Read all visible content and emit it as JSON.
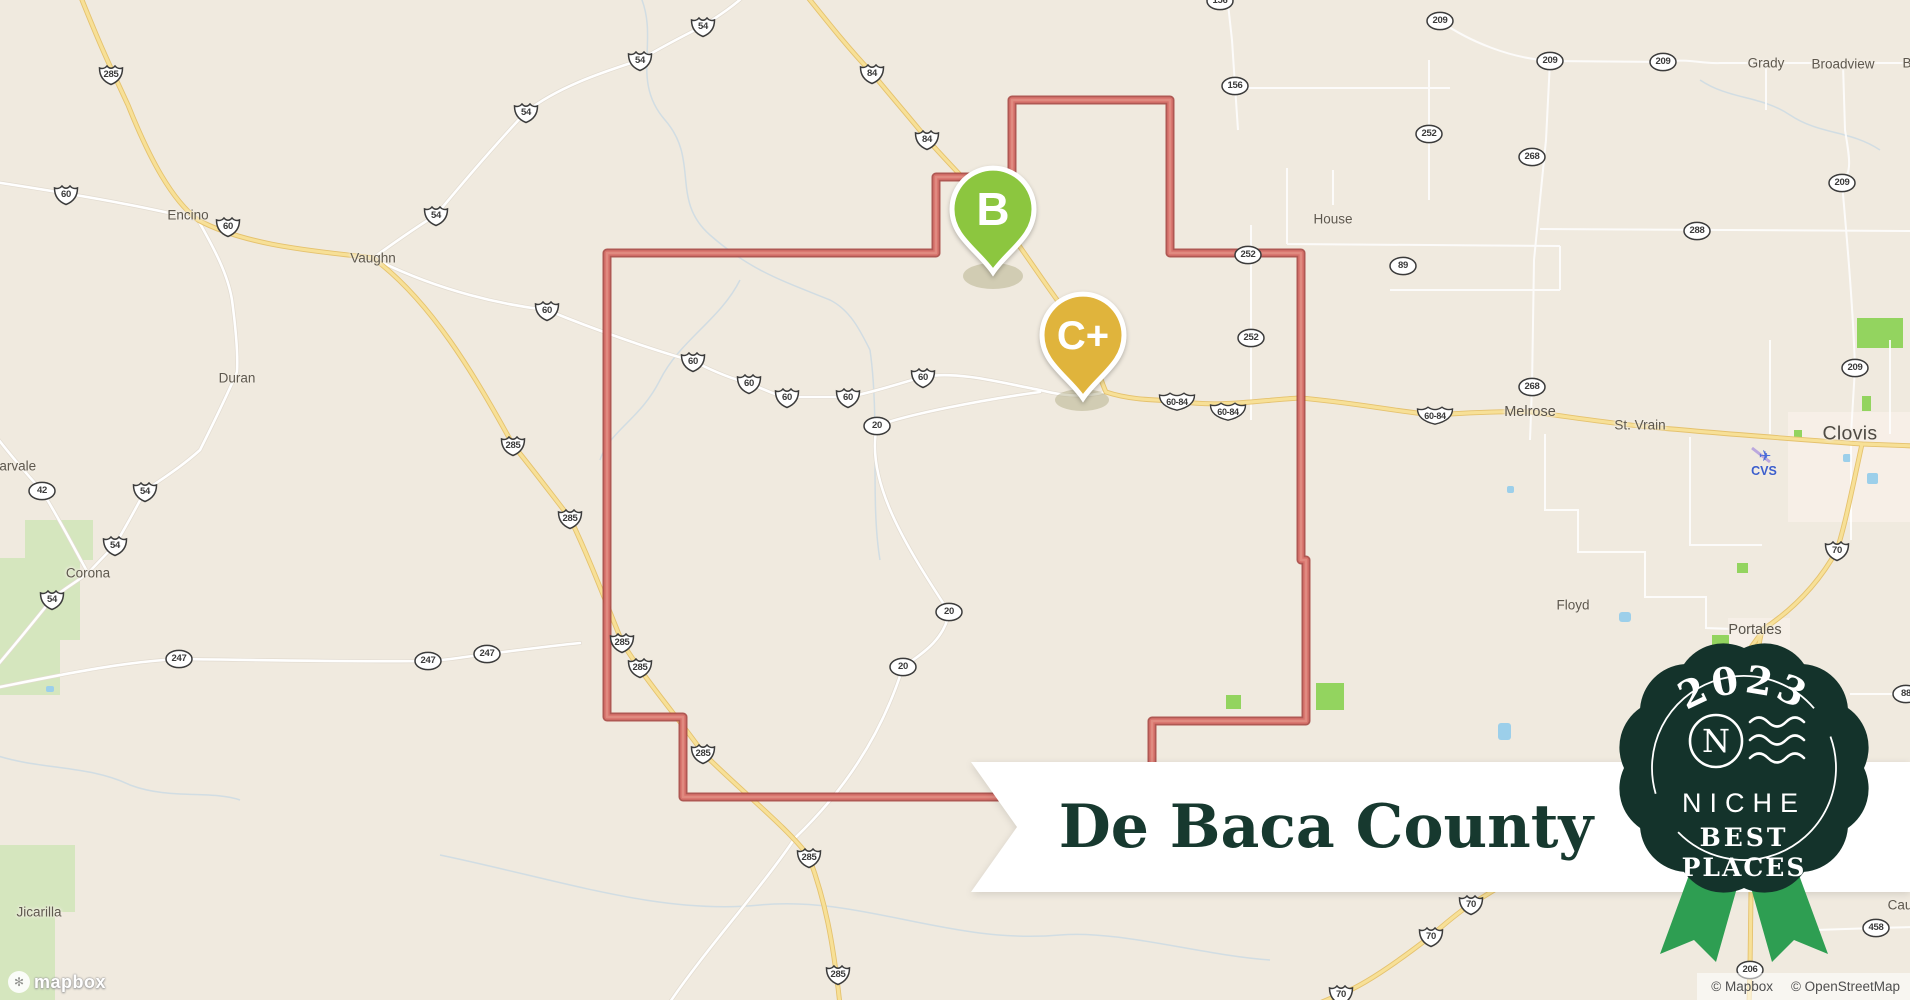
{
  "map": {
    "banner": {
      "title": "De Baca County"
    },
    "badge": {
      "year": "2023",
      "brand": "NICHE",
      "line1": "BEST",
      "line2": "PLACES"
    },
    "markers": [
      {
        "grade": "B",
        "color": "#8CC63F",
        "x": 993,
        "y": 210
      },
      {
        "grade": "C+",
        "color": "#E0B43C",
        "x": 1083,
        "y": 336
      }
    ],
    "towns": [
      {
        "name": "Encino",
        "x": 188,
        "y": 215,
        "cls": "sm"
      },
      {
        "name": "Vaughn",
        "x": 373,
        "y": 258,
        "cls": "sm"
      },
      {
        "name": "Duran",
        "x": 237,
        "y": 378,
        "cls": "sm"
      },
      {
        "name": "Corona",
        "x": 88,
        "y": 573,
        "cls": "sm"
      },
      {
        "name": "darvale",
        "x": 14,
        "y": 466,
        "cls": "sm"
      },
      {
        "name": "Jicarilla",
        "x": 39,
        "y": 912,
        "cls": "sm"
      },
      {
        "name": "House",
        "x": 1333,
        "y": 219,
        "cls": "sm"
      },
      {
        "name": "Melrose",
        "x": 1530,
        "y": 412,
        "cls": "md"
      },
      {
        "name": "St. Vrain",
        "x": 1640,
        "y": 425,
        "cls": "sm"
      },
      {
        "name": "Clovis",
        "x": 1850,
        "y": 434,
        "cls": "lg"
      },
      {
        "name": "Floyd",
        "x": 1573,
        "y": 605,
        "cls": "sm"
      },
      {
        "name": "Portales",
        "x": 1755,
        "y": 630,
        "cls": "md"
      },
      {
        "name": "Grady",
        "x": 1766,
        "y": 63,
        "cls": "sm"
      },
      {
        "name": "Broadview",
        "x": 1843,
        "y": 64,
        "cls": "sm"
      },
      {
        "name": "B",
        "x": 1907,
        "y": 63,
        "cls": "sm"
      },
      {
        "name": "Cau",
        "x": 1900,
        "y": 905,
        "cls": "sm"
      },
      {
        "name": "CVS",
        "x": 1764,
        "y": 471,
        "cls": "cvs"
      }
    ],
    "shields": [
      {
        "type": "us",
        "label": "54",
        "x": 703,
        "y": 26
      },
      {
        "type": "us",
        "label": "54",
        "x": 640,
        "y": 60
      },
      {
        "type": "us",
        "label": "54",
        "x": 526,
        "y": 112
      },
      {
        "type": "us",
        "label": "54",
        "x": 436,
        "y": 215
      },
      {
        "type": "us",
        "label": "54",
        "x": 145,
        "y": 491
      },
      {
        "type": "us",
        "label": "54",
        "x": 115,
        "y": 545
      },
      {
        "type": "us",
        "label": "54",
        "x": 52,
        "y": 599
      },
      {
        "type": "us",
        "label": "84",
        "x": 872,
        "y": 73
      },
      {
        "type": "us",
        "label": "84",
        "x": 927,
        "y": 139
      },
      {
        "type": "us",
        "label": "60",
        "x": 66,
        "y": 194
      },
      {
        "type": "us",
        "label": "60",
        "x": 228,
        "y": 226
      },
      {
        "type": "us",
        "label": "60",
        "x": 547,
        "y": 310
      },
      {
        "type": "us",
        "label": "60",
        "x": 693,
        "y": 361
      },
      {
        "type": "us",
        "label": "60",
        "x": 749,
        "y": 383
      },
      {
        "type": "us",
        "label": "60",
        "x": 787,
        "y": 397
      },
      {
        "type": "us",
        "label": "60",
        "x": 848,
        "y": 397
      },
      {
        "type": "us",
        "label": "60",
        "x": 923,
        "y": 377
      },
      {
        "type": "us",
        "label": "285",
        "x": 111,
        "y": 74
      },
      {
        "type": "us",
        "label": "285",
        "x": 513,
        "y": 445
      },
      {
        "type": "us",
        "label": "285",
        "x": 570,
        "y": 518
      },
      {
        "type": "us",
        "label": "285",
        "x": 622,
        "y": 642
      },
      {
        "type": "us",
        "label": "285",
        "x": 640,
        "y": 667
      },
      {
        "type": "us",
        "label": "285",
        "x": 703,
        "y": 753
      },
      {
        "type": "us",
        "label": "285",
        "x": 809,
        "y": 857
      },
      {
        "type": "us",
        "label": "285",
        "x": 838,
        "y": 974
      },
      {
        "type": "us",
        "label": "70",
        "x": 1837,
        "y": 550
      },
      {
        "type": "us",
        "label": "70",
        "x": 1471,
        "y": 904
      },
      {
        "type": "us",
        "label": "70",
        "x": 1431,
        "y": 936
      },
      {
        "type": "us",
        "label": "70",
        "x": 1341,
        "y": 994
      },
      {
        "type": "usw",
        "label": "60-84",
        "x": 1177,
        "y": 401
      },
      {
        "type": "usw",
        "label": "60-84",
        "x": 1228,
        "y": 411
      },
      {
        "type": "usw",
        "label": "60-84",
        "x": 1435,
        "y": 415
      },
      {
        "type": "ov",
        "label": "209",
        "x": 1440,
        "y": 21
      },
      {
        "type": "ov",
        "label": "209",
        "x": 1550,
        "y": 61
      },
      {
        "type": "ov",
        "label": "209",
        "x": 1663,
        "y": 62
      },
      {
        "type": "ov",
        "label": "209",
        "x": 1842,
        "y": 183
      },
      {
        "type": "ov",
        "label": "209",
        "x": 1855,
        "y": 368
      },
      {
        "type": "ov",
        "label": "252",
        "x": 1429,
        "y": 134
      },
      {
        "type": "ov",
        "label": "252",
        "x": 1248,
        "y": 255
      },
      {
        "type": "ov",
        "label": "252",
        "x": 1251,
        "y": 338
      },
      {
        "type": "ov",
        "label": "268",
        "x": 1532,
        "y": 157
      },
      {
        "type": "ov",
        "label": "268",
        "x": 1532,
        "y": 387
      },
      {
        "type": "ov",
        "label": "288",
        "x": 1697,
        "y": 231
      },
      {
        "type": "ov",
        "label": "89",
        "x": 1403,
        "y": 266
      },
      {
        "type": "ov",
        "label": "156",
        "x": 1220,
        "y": 1
      },
      {
        "type": "ov",
        "label": "156",
        "x": 1235,
        "y": 86
      },
      {
        "type": "ov",
        "label": "42",
        "x": 42,
        "y": 491
      },
      {
        "type": "ov",
        "label": "247",
        "x": 179,
        "y": 659
      },
      {
        "type": "ov",
        "label": "247",
        "x": 428,
        "y": 661
      },
      {
        "type": "ov",
        "label": "247",
        "x": 487,
        "y": 654
      },
      {
        "type": "ov",
        "label": "20",
        "x": 877,
        "y": 426
      },
      {
        "type": "ov",
        "label": "20",
        "x": 949,
        "y": 612
      },
      {
        "type": "ov",
        "label": "20",
        "x": 903,
        "y": 667
      },
      {
        "type": "ov",
        "label": "88",
        "x": 1906,
        "y": 694
      },
      {
        "type": "ov",
        "label": "458",
        "x": 1876,
        "y": 928
      },
      {
        "type": "ov",
        "label": "206",
        "x": 1750,
        "y": 970
      }
    ],
    "attribution": {
      "items": [
        "© Mapbox",
        "© OpenStreetMap"
      ]
    },
    "logo": {
      "text": "mapbox"
    },
    "colors": {
      "land": "#F0EADF",
      "boundary": "#D8736C",
      "boundary_dark": "#A94B47",
      "road_major": "#F7E097",
      "road_major_casing": "#E5C26E",
      "road_minor": "#FFFFFF",
      "wilderness": "#D5E6BE",
      "park": "#93D45F",
      "water": "#9CCFEA",
      "marker_b": "#8CC63F",
      "marker_c": "#E0B43C",
      "badge_bg": "#14332B",
      "ribbon": "#2E9E52",
      "banner_bg": "#FFFFFF",
      "banner_text": "#17392F"
    }
  }
}
